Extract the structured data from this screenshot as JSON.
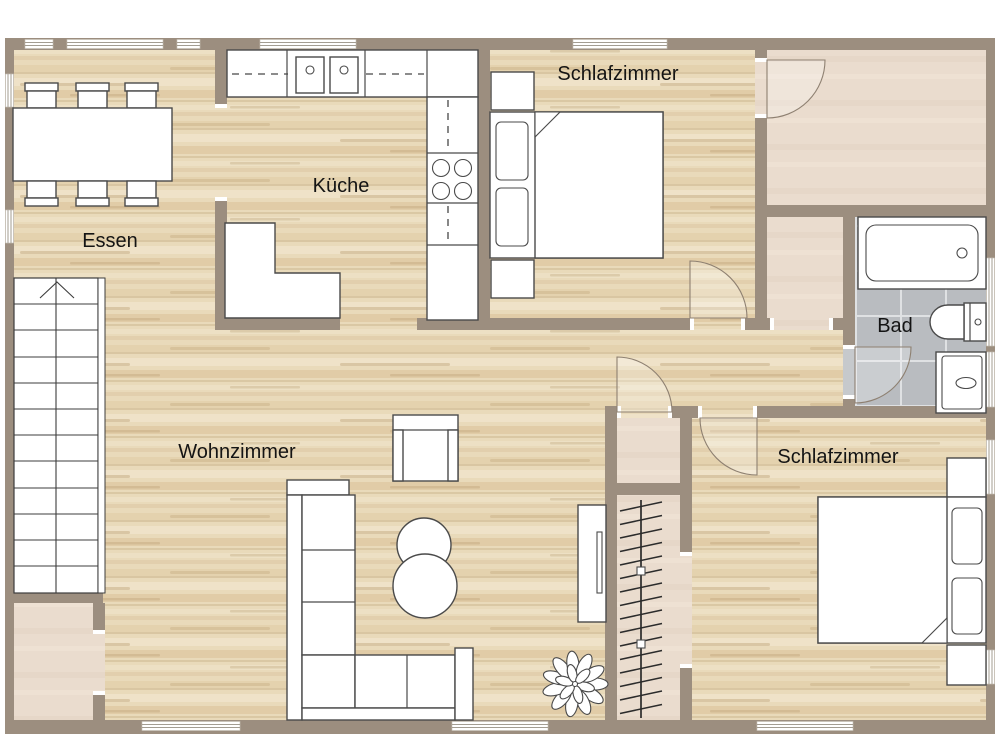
{
  "palette": {
    "wall": "#9c8e7f",
    "wood": "#e9daba",
    "beige": "#eadcce",
    "tile": "#b9bcc0",
    "outline": "#4a4a4a",
    "arc": "#8e8071",
    "text": "#141414"
  },
  "rooms": {
    "dining": {
      "label": "Essen"
    },
    "kitchen": {
      "label": "Küche"
    },
    "bedroom_top": {
      "label": "Schlafzimmer"
    },
    "bathroom": {
      "label": "Bad"
    },
    "living": {
      "label": "Wohnzimmer"
    },
    "bedroom_bottom": {
      "label": "Schlafzimmer"
    }
  }
}
